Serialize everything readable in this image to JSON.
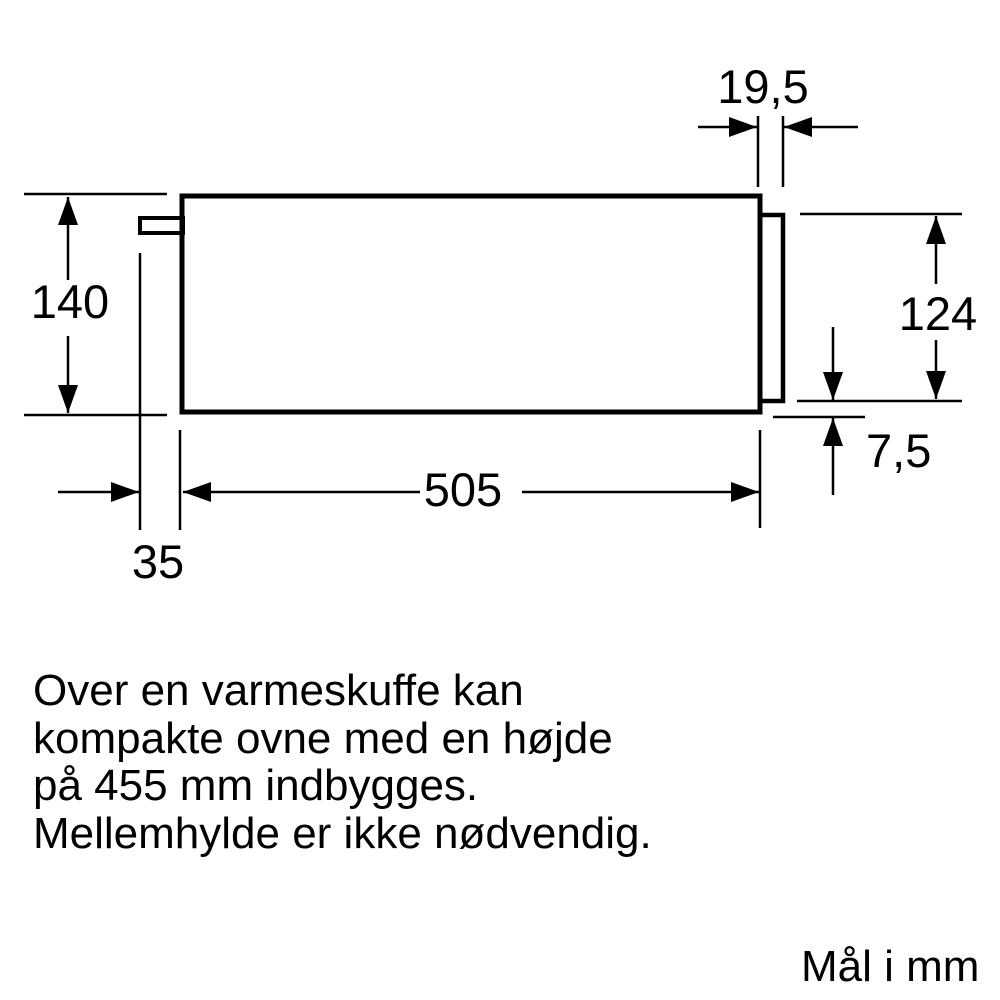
{
  "drawing": {
    "labels": {
      "front_panel_thickness": "19,5",
      "niche_height": "140",
      "front_panel_height": "124",
      "bottom_gap": "7,5",
      "body_depth": "505",
      "rear_offset": "35"
    },
    "values_mm": {
      "front_panel_thickness": 19.5,
      "niche_height": 140,
      "front_panel_height": 124,
      "bottom_gap": 7.5,
      "body_depth": 505,
      "rear_offset": 35
    },
    "colors": {
      "line": "#000000",
      "background": "#ffffff"
    }
  },
  "note": {
    "lines": [
      "Over en varmeskuffe kan",
      "kompakte ovne med en højde",
      "på 455 mm indbygges.",
      "Mellemhylde er ikke nødvendig."
    ]
  },
  "units_label": "Mål i mm"
}
